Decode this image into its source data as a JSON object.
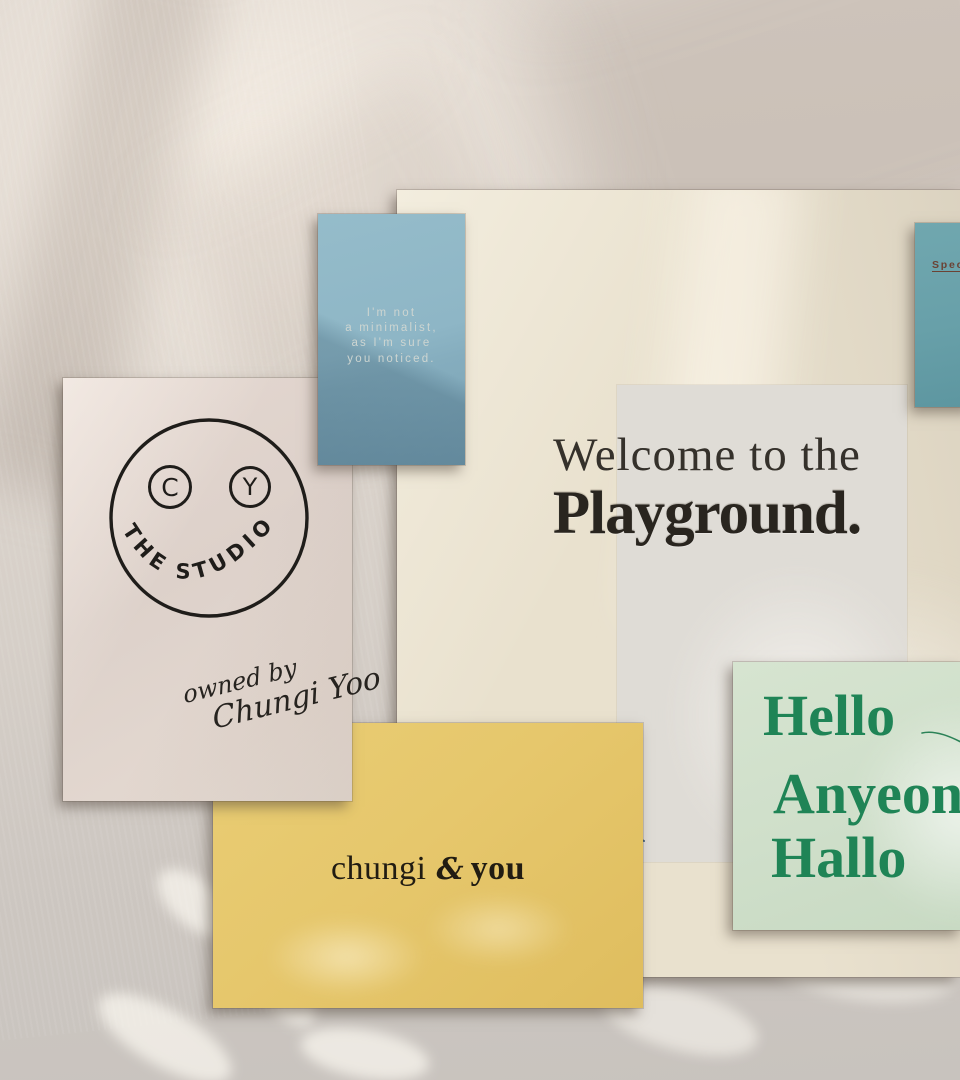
{
  "artboard": {
    "width": 960,
    "height": 1080
  },
  "palette": {
    "wall": "#d7d0c9",
    "poster_bg": "#e9e1ce",
    "panel_bg": "#dfdcd6",
    "blue_card_bg": "#8eb6c6",
    "blue_card_text": "#cdd5d1",
    "teal_card_bg": "#68a0a9",
    "special_text": "#6b4234",
    "studio_card_bg": "#ddd1ca",
    "ink": "#23211d",
    "yellow_card_bg": "#e6c76c",
    "green_card_bg": "#cfdfca",
    "green_text": "#1f8456",
    "squiggle_line": "#3b5c7c"
  },
  "cards": {
    "blue_note": {
      "lines": [
        "I'm not",
        "a minimalist,",
        "as I'm sure",
        "you noticed."
      ]
    },
    "special_tag": {
      "label": "Special"
    },
    "studio": {
      "eye_left": "C",
      "eye_right": "Y",
      "arc_text": "THE STUDIO",
      "signature_line1": "owned by",
      "signature_line2": "Chungi Yoo"
    },
    "playground_poster": {
      "heading_line1": "Welcome to the",
      "heading_line2": "Playground."
    },
    "chungi_you": {
      "word1": "chungi",
      "ampersand": "&",
      "word2": "you"
    },
    "greetings": {
      "line1": "Hello",
      "line2": "Anyeong",
      "line3": "Hallo"
    }
  }
}
